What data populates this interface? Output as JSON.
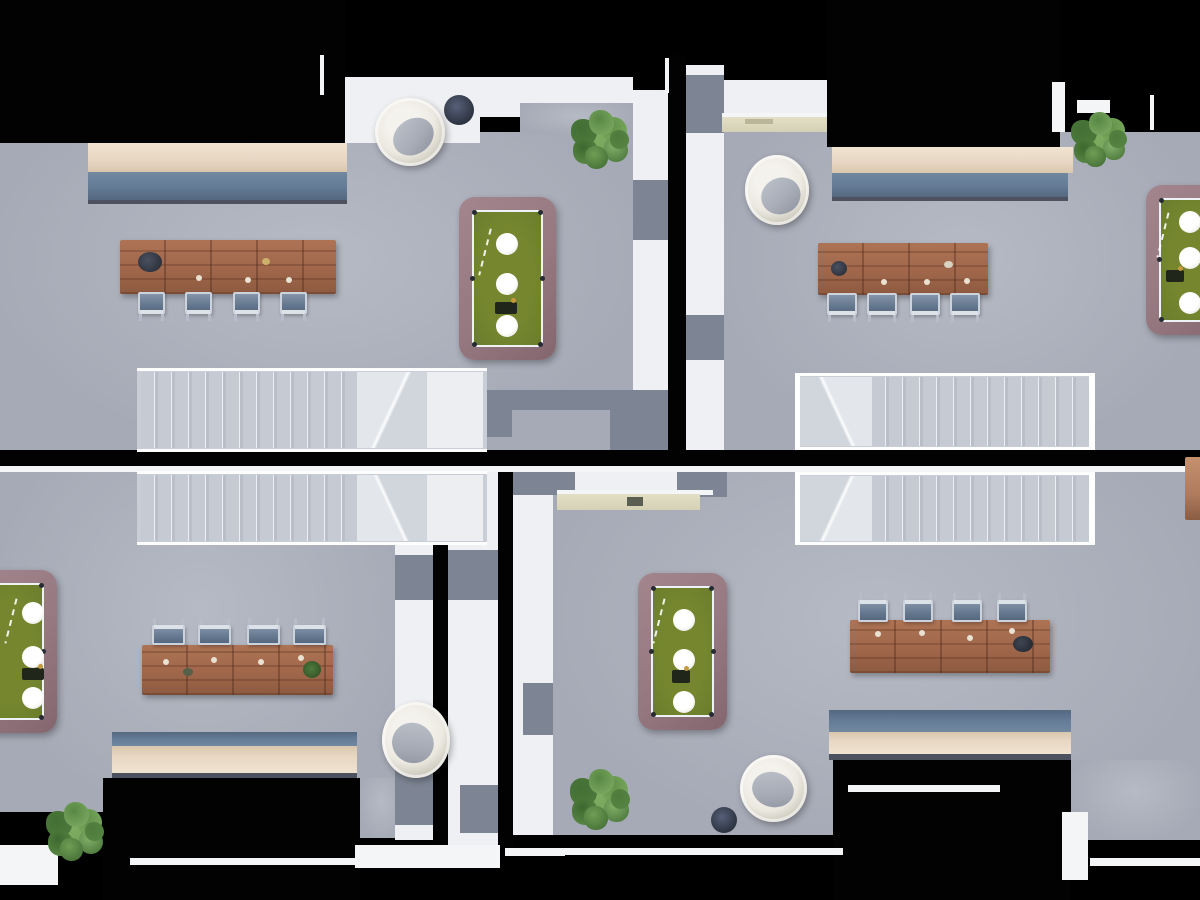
{
  "scene": {
    "description": "Top-down 3D architectural rendering of four mirrored open-plan apartment units on a black background, connected by tiled walkways",
    "view": "top-down floor plan render",
    "units_count": 4
  },
  "colors": {
    "background": "#000000",
    "floor_gray": "#a6aab6",
    "floor_light": "#b6bac4",
    "tile_white": "#eef0f3",
    "tile_gray": "#7d8493",
    "wall_black": "#020202",
    "wall_cap_white": "#f4f5f7",
    "counter_cream": "#e7d7c3",
    "counter_blue": "#647b96",
    "counter_shadow": "#4c5260",
    "stair_base": "#c9ced6",
    "stair_step_light": "#eceff3",
    "stair_step_dark": "#b9bec8",
    "stair_landing": "#eceef1",
    "pool_frame_mauve": "#967881",
    "pool_felt_green": "#6b7d2c",
    "pool_line_white": "#edf2f4",
    "pool_pocket": "#262b33",
    "ball_white": "#ffffff",
    "wood_brown": "#a2684c",
    "wood_dark": "#7e4f38",
    "chair_seat_blue": "#64788f",
    "chair_frame_light": "#ccd3dc",
    "egg_chair_cream": "#ece9e1",
    "egg_cushion_gray": "#a6abb5",
    "plant_green": "#5f9048",
    "pot_dark_navy": "#333a49",
    "shelf_khaki": "#d5d1b5",
    "bench_wood_sliver": "#b07a5e"
  },
  "corridor": {
    "description": "checkered tiled walkways between units",
    "tile_colors": [
      "white",
      "grey"
    ],
    "separating_walls": "black with thin white caps"
  },
  "units": [
    {
      "id": "top-left",
      "position": "top-left",
      "furniture": {
        "kitchen_counter": 1,
        "dining_table": 1,
        "dining_chairs": 4,
        "pool_table": 1,
        "pool_table_light_circles": 3,
        "staircase": 1,
        "staircase_steps": 13,
        "egg_chair": 1,
        "plant": 1,
        "planter_pot": 1
      }
    },
    {
      "id": "top-right",
      "position": "top-right",
      "furniture": {
        "kitchen_counter": 1,
        "dining_table": 1,
        "dining_chairs": 4,
        "pool_table": 1,
        "pool_table_light_circles": 3,
        "staircase": 1,
        "staircase_steps": 13,
        "egg_chair": 1,
        "plant": 1,
        "planter_pot": 0,
        "sideboard_shelf": 1
      }
    },
    {
      "id": "bottom-left",
      "position": "bottom-left",
      "furniture": {
        "kitchen_counter": 1,
        "dining_table": 1,
        "dining_chairs": 4,
        "pool_table": 1,
        "pool_table_light_circles": 3,
        "staircase": 1,
        "staircase_steps": 13,
        "egg_chair": 1,
        "plant": 1,
        "planter_pot": 0
      }
    },
    {
      "id": "bottom-right",
      "position": "bottom-right",
      "furniture": {
        "kitchen_counter": 1,
        "dining_table": 1,
        "dining_chairs": 4,
        "pool_table": 1,
        "pool_table_light_circles": 3,
        "staircase": 1,
        "staircase_steps": 13,
        "egg_chair": 1,
        "plant": 1,
        "planter_pot": 1,
        "sideboard_shelf": 1
      }
    }
  ]
}
